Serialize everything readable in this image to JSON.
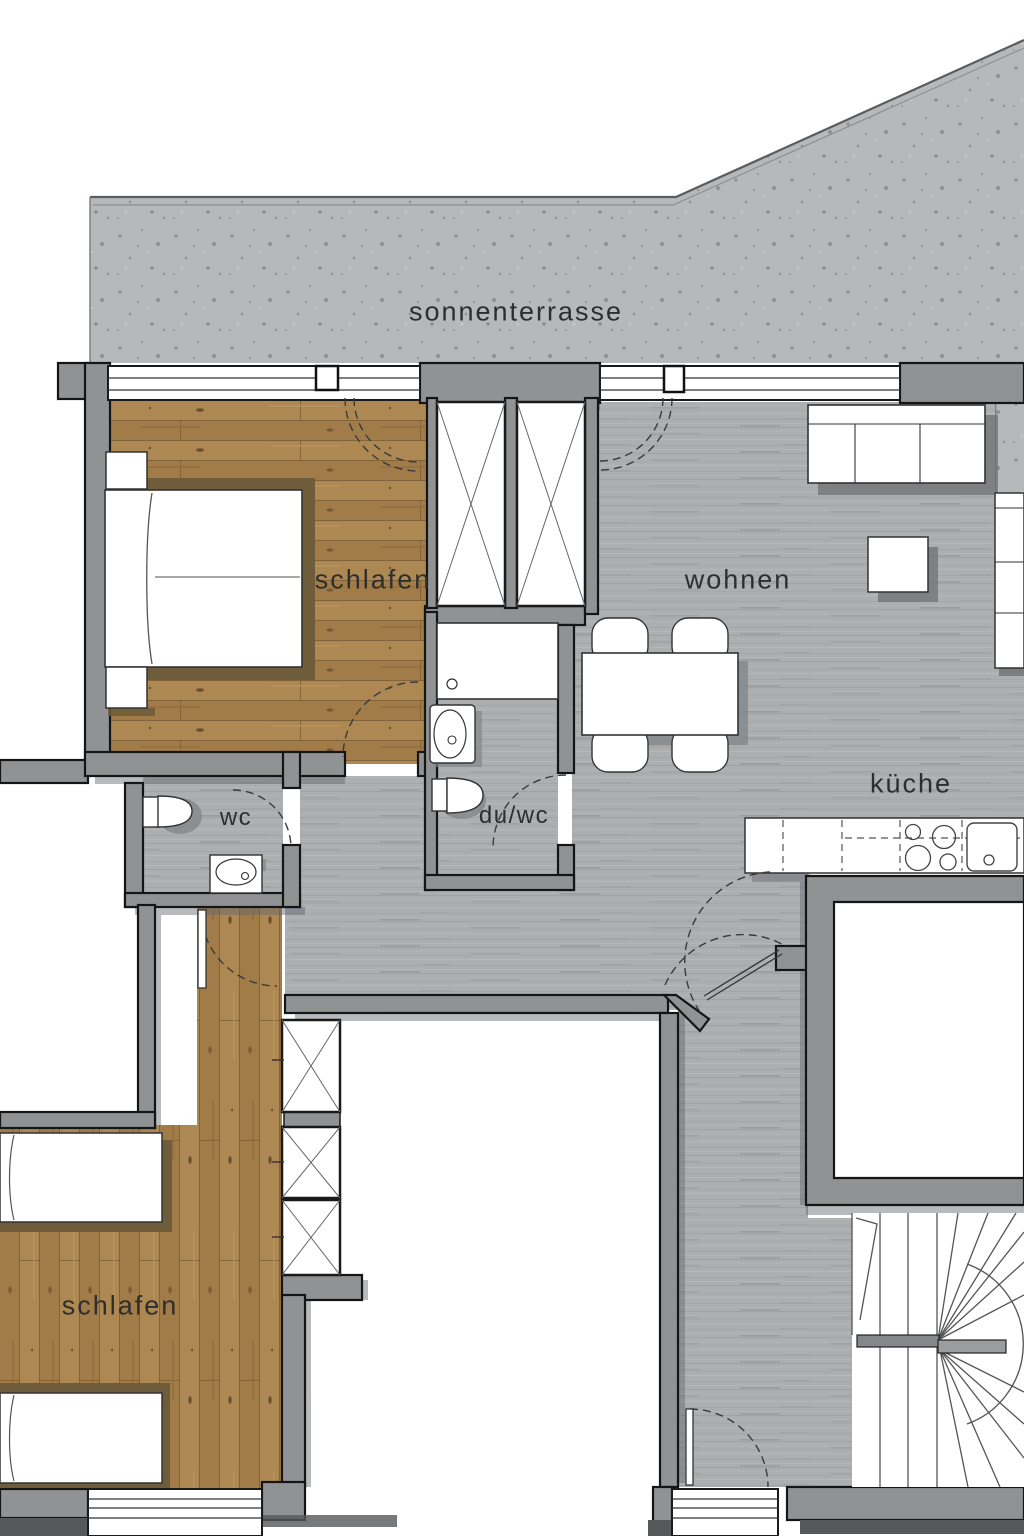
{
  "plan": {
    "labels": {
      "terrace": "sonnenterrasse",
      "bedroom1": "schlafen",
      "living": "wohnen",
      "kitchen": "küche",
      "wc": "wc",
      "shower_wc": "du/wc",
      "bedroom2": "schlafen"
    },
    "colors": {
      "wall": "#909294",
      "wall_outline": "#151515",
      "concrete_terrace": "#b6b8b9",
      "gray_wood_floor": "#acaeb0",
      "oak_wood_floor": "#a9844f",
      "furniture": "#ffffff",
      "shadow": "#6b6d6f",
      "bed_shadow": "#6e5c3b"
    },
    "symbols": [
      "double-bed",
      "single-bed",
      "nightstand",
      "wardrobe",
      "shaft",
      "sofa",
      "coffee-table",
      "dining-table",
      "chair",
      "kitchen-counter",
      "cooktop",
      "kitchen-sink",
      "toilet",
      "washbasin",
      "shower",
      "winder-stairs",
      "door-swing",
      "window",
      "entrance-door"
    ]
  }
}
